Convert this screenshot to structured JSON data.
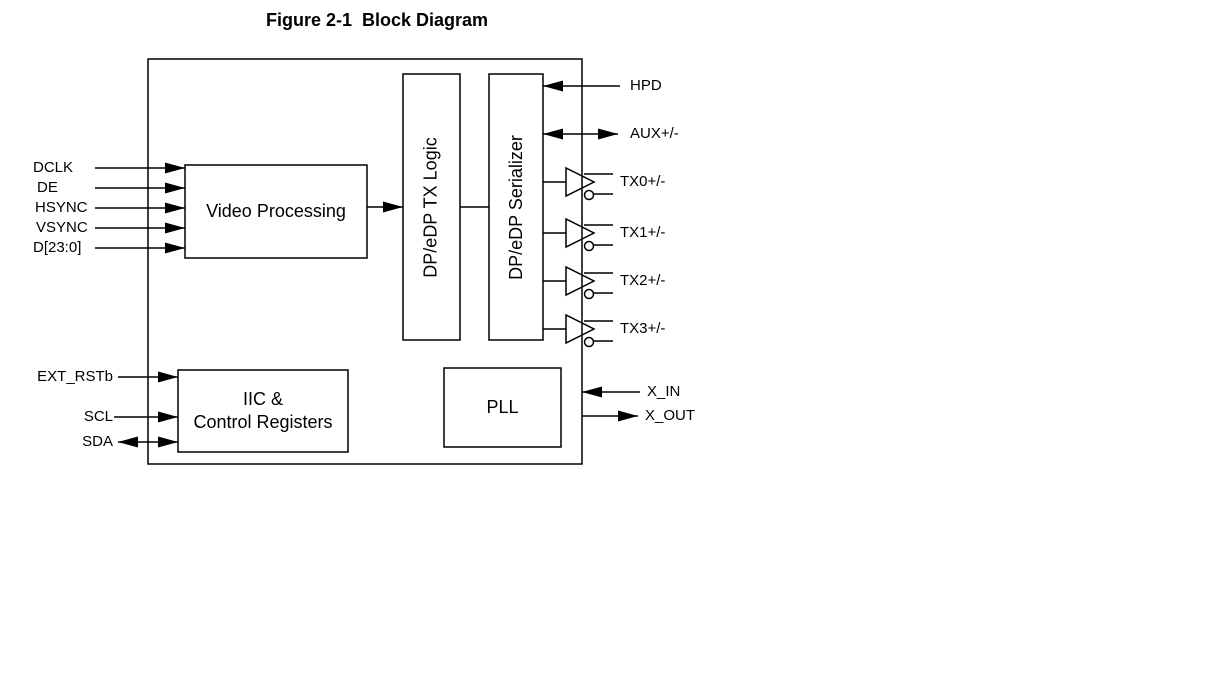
{
  "figure": {
    "title": "Figure 2-1  Block Diagram"
  },
  "blocks": {
    "video_processing": {
      "label": "Video Processing"
    },
    "dp_edp_tx_logic": {
      "label": "DP/eDP TX Logic"
    },
    "dp_edp_serializer": {
      "label": "DP/eDP Serializer"
    },
    "iic_control_registers": {
      "line1": "IIC &",
      "line2": "Control Registers"
    },
    "pll": {
      "label": "PLL"
    }
  },
  "pins": {
    "left": [
      {
        "label": "DCLK",
        "direction": "input"
      },
      {
        "label": "DE",
        "direction": "input"
      },
      {
        "label": "HSYNC",
        "direction": "input"
      },
      {
        "label": "VSYNC",
        "direction": "input"
      },
      {
        "label": "D[23:0]",
        "direction": "input"
      },
      {
        "label": "EXT_RSTb",
        "direction": "input"
      },
      {
        "label": "SCL",
        "direction": "input"
      },
      {
        "label": "SDA",
        "direction": "bidirectional"
      }
    ],
    "right": [
      {
        "label": "HPD",
        "direction": "input"
      },
      {
        "label": "AUX+/-",
        "direction": "bidirectional"
      },
      {
        "label": "TX0+/-",
        "direction": "output"
      },
      {
        "label": "TX1+/-",
        "direction": "output"
      },
      {
        "label": "TX2+/-",
        "direction": "output"
      },
      {
        "label": "TX3+/-",
        "direction": "output"
      },
      {
        "label": "X_IN",
        "direction": "input"
      },
      {
        "label": "X_OUT",
        "direction": "output"
      }
    ]
  },
  "colors": {
    "line": "#000000",
    "background": "#ffffff",
    "text": "#000000"
  }
}
